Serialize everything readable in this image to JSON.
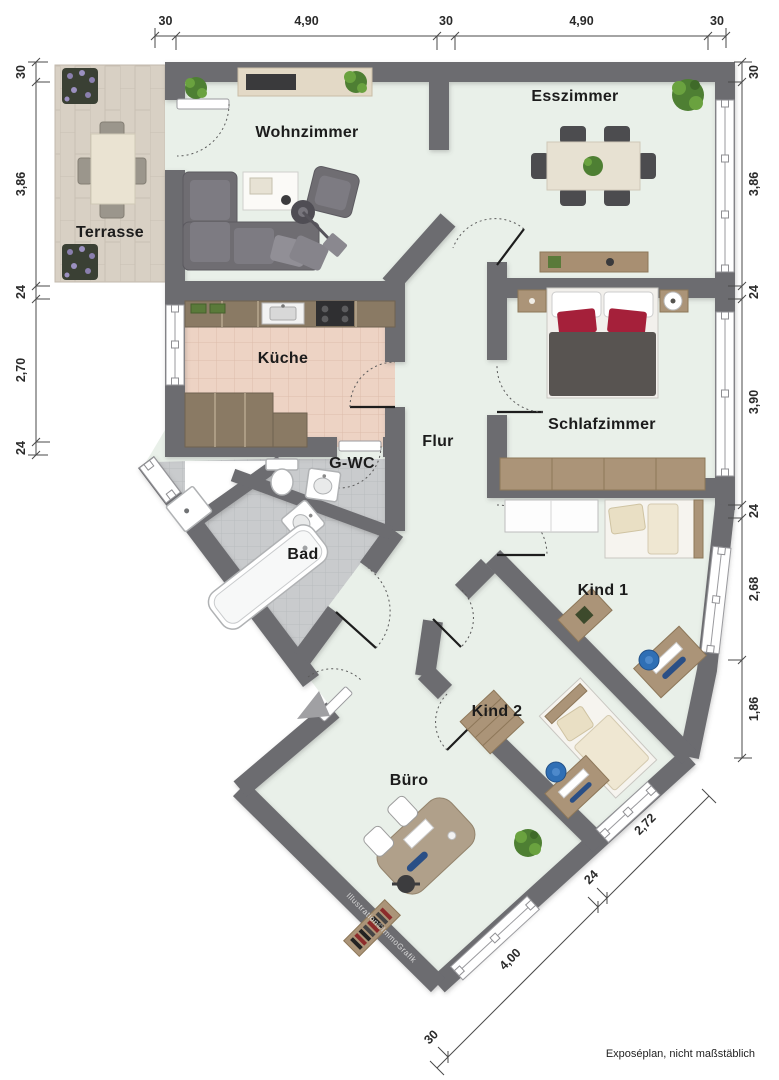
{
  "title": "Floor plan",
  "rooms": {
    "terrasse": {
      "label": "Terrasse"
    },
    "wohnzimmer": {
      "label": "Wohnzimmer"
    },
    "esszimmer": {
      "label": "Esszimmer"
    },
    "kueche": {
      "label": "Küche"
    },
    "schlafzimmer": {
      "label": "Schlafzimmer"
    },
    "flur": {
      "label": "Flur"
    },
    "gwc": {
      "label": "G-WC"
    },
    "bad": {
      "label": "Bad"
    },
    "kind1": {
      "label": "Kind 1"
    },
    "kind2": {
      "label": "Kind 2"
    },
    "buero": {
      "label": "Büro"
    }
  },
  "dimensions": {
    "top": [
      "30",
      "4,90",
      "30",
      "4,90",
      "30"
    ],
    "left": [
      "30",
      "3,86",
      "24",
      "2,70",
      "24"
    ],
    "right": [
      "30",
      "3,86",
      "24",
      "3,90",
      "24",
      "2,68",
      "1,86"
    ],
    "bottom": [
      "30",
      "4,00",
      "24",
      "2,72"
    ]
  },
  "annotations": {
    "watermark": "Illustration©ImmoGrafik",
    "disclaimer": "Exposéplan, nicht maßstäblich"
  },
  "colors": {
    "wall": "#6c6c70",
    "floor": "#e9f0e9",
    "terrace_floor": "#d8d0c4",
    "kitchen_floor": "#edd3c4",
    "bath_floor": "#c9cbcd",
    "wood": "#ab9478",
    "sofa_gray": "#6f6d72",
    "accent_red": "#a5203a",
    "accent_blue": "#2f6fb5",
    "plant_green": "#5c8f3c"
  }
}
